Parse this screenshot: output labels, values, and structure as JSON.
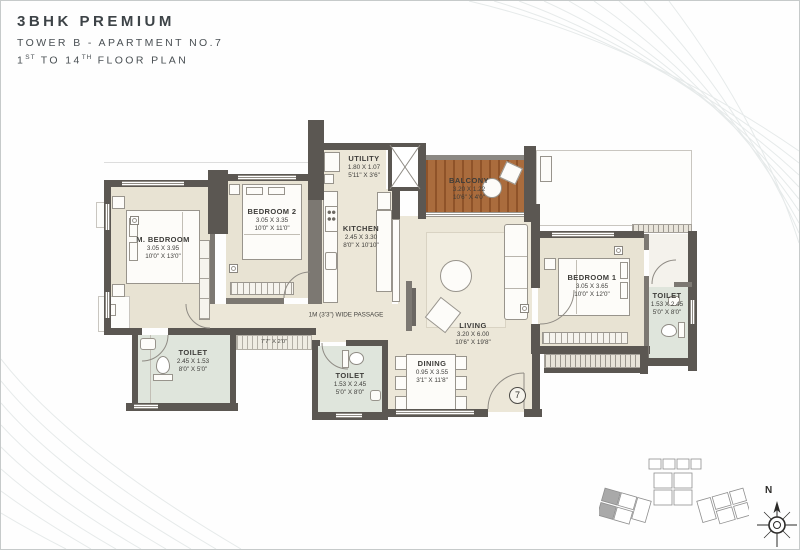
{
  "title": {
    "line1": "3BHK PREMIUM",
    "line2": "TOWER B - APARTMENT NO.7",
    "line3": {
      "n1": "1",
      "s1": "ST",
      "mid": " TO 14",
      "s2": "TH",
      "rest": " FLOOR PLAN"
    }
  },
  "rooms": {
    "m_bedroom": {
      "name": "M. BEDROOM",
      "metric": "3.05 X 3.95",
      "imperial": "10'0\" X 13'0\""
    },
    "bedroom2": {
      "name": "BEDROOM 2",
      "metric": "3.05 X 3.35",
      "imperial": "10'0\" X 11'0\""
    },
    "bedroom1": {
      "name": "BEDROOM 1",
      "metric": "3.05 X 3.65",
      "imperial": "10'0\" X 12'0\""
    },
    "kitchen": {
      "name": "KITCHEN",
      "metric": "2.45 X 3.30",
      "imperial": "8'0\" X 10'10\""
    },
    "utility": {
      "name": "UTILITY",
      "metric": "1.80 X 1.07",
      "imperial": "5'11\" X 3'6\""
    },
    "balcony": {
      "name": "BALCONY",
      "metric": "3.20 X 1.22",
      "imperial": "10'6\" X 4'0\""
    },
    "living": {
      "name": "LIVING",
      "metric": "3.20 X 6.00",
      "imperial": "10'6\" X 19'8\""
    },
    "dining": {
      "name": "DINING",
      "metric": "0.95 X 3.55",
      "imperial": "3'1\" X 11'8\""
    },
    "toilet_master": {
      "name": "TOILET",
      "metric": "2.45 X 1.53",
      "imperial": "8'0\" X 5'0\""
    },
    "toilet_common": {
      "name": "TOILET",
      "metric": "1.53 X 2.45",
      "imperial": "5'0\" X 8'0\""
    },
    "toilet_bedroom1": {
      "name": "TOILET",
      "metric": "1.53 X 2.45",
      "imperial": "5'0\" X 8'0\""
    }
  },
  "annotations": {
    "passage": "1M (3'3\") WIDE PASSAGE",
    "ledge_dim": "7'7\" X 2'0\"",
    "apartment_number": "7",
    "compass_north": "N"
  },
  "colors": {
    "wall": "#5b5752",
    "floor": "#ece7d8",
    "toilet_floor": "#dfe5dc",
    "balcony_deck": "#aa6c3d",
    "title_text": "#3d4347"
  }
}
